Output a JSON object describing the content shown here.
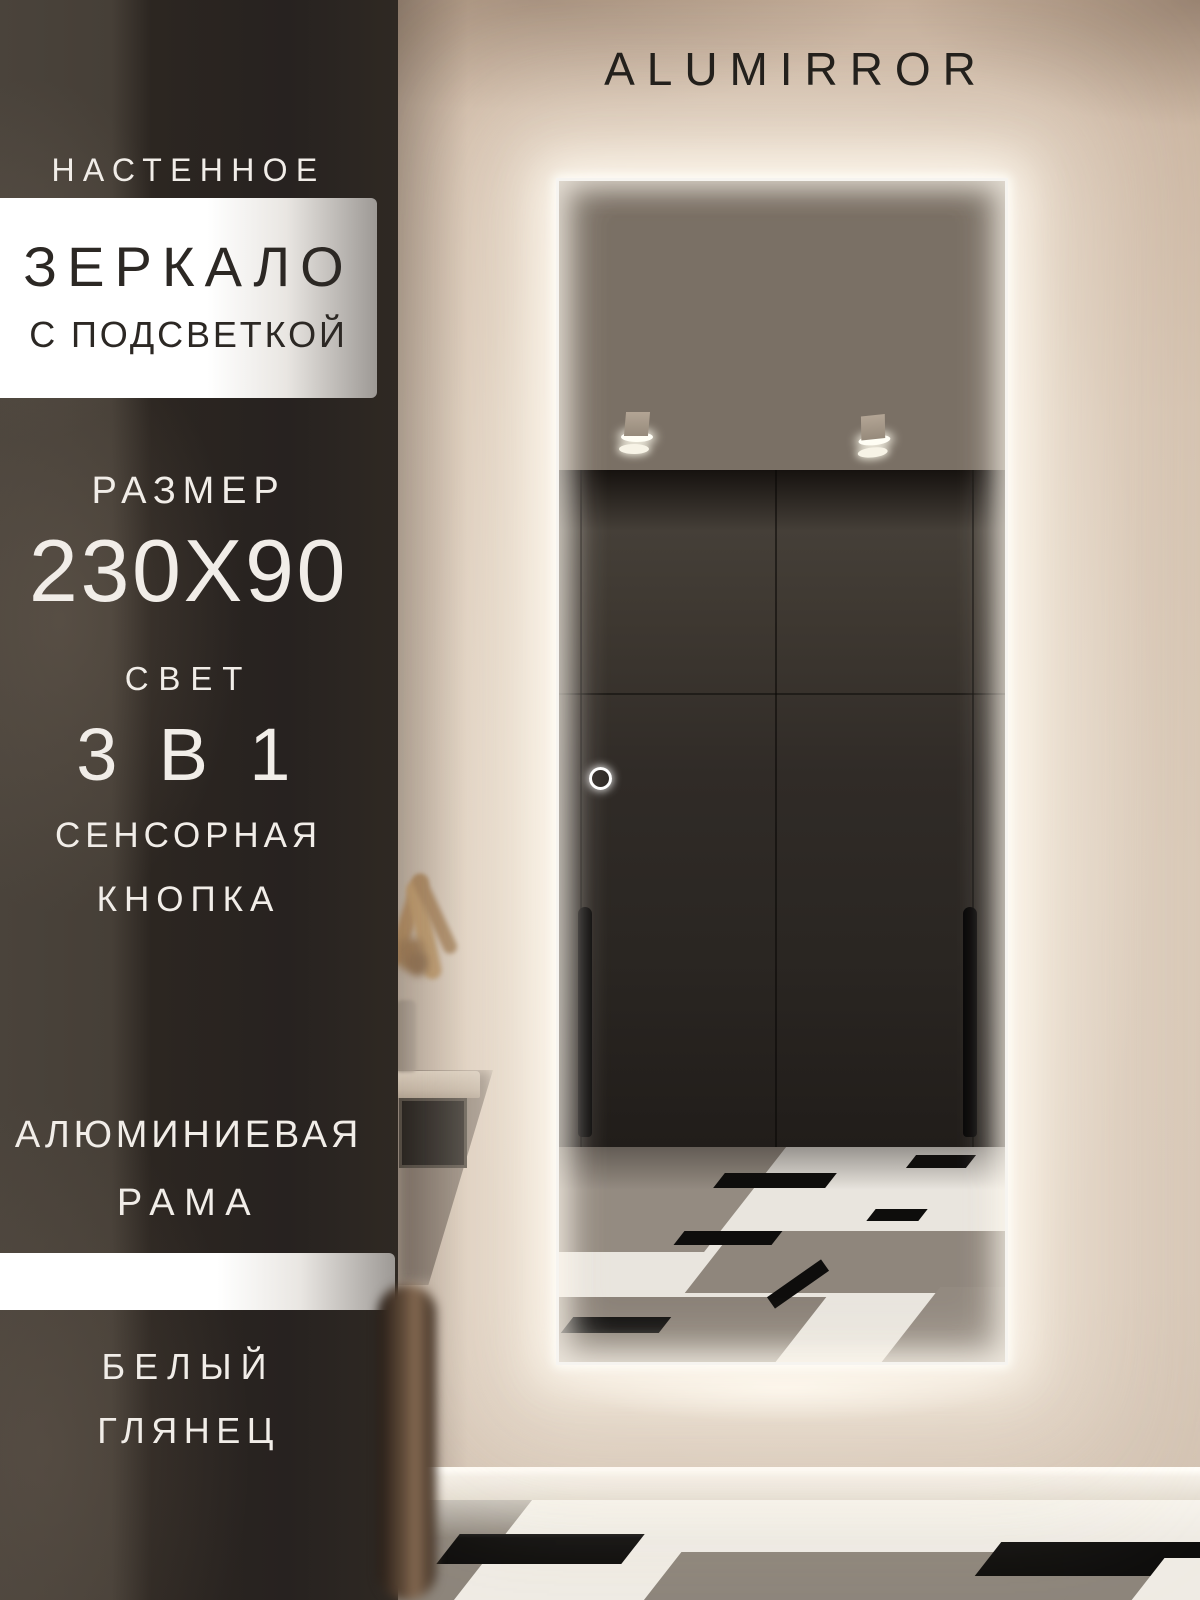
{
  "brand": "ALUMIRROR",
  "left_panel": {
    "subtitle_top": "НАСТЕННОЕ",
    "title": "ЗЕРКАЛО",
    "subtitle_bottom": "С ПОДСВЕТКОЙ",
    "size_label": "РАЗМЕР",
    "size_value": "230X90",
    "light_label": "СВЕТ",
    "light_value": "3 В 1",
    "touch_line1": "СЕНСОРНАЯ",
    "touch_line2": "КНОПКА",
    "frame_line1": "АЛЮМИНИЕВАЯ",
    "frame_line2": "РАМА",
    "finish_line1": "БЕЛЫЙ",
    "finish_line2": "ГЛЯНЕЦ"
  },
  "colors": {
    "led_glow": "#FFF8EC",
    "panel_dark": "#2A2420",
    "wall_beige": "#D6C4B2",
    "banner_white": "#FFFFFF",
    "text_on_panel": "#F1EDE8",
    "text_on_banner": "#2C2824",
    "wardrobe": "#2B2723",
    "floor_grey": "#8F877D",
    "floor_white": "#ECE8E1",
    "floor_black": "#0E0D0C"
  }
}
